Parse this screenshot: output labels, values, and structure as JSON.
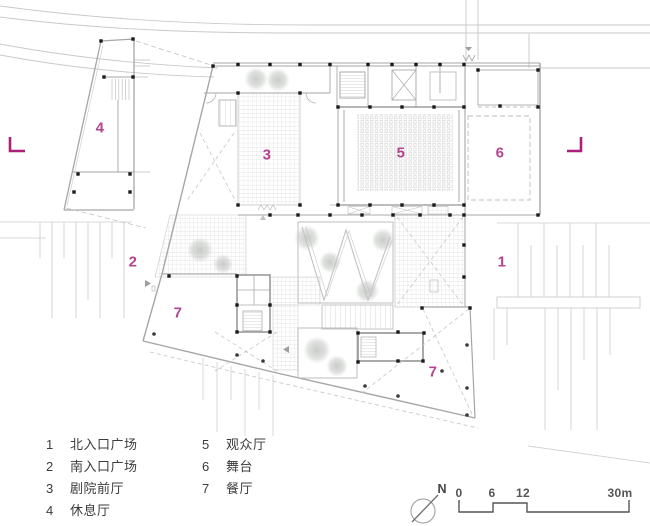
{
  "plan": {
    "zones": [
      {
        "id": "zone-4",
        "num": "4"
      },
      {
        "id": "zone-2",
        "num": "2"
      },
      {
        "id": "zone-3",
        "num": "3"
      },
      {
        "id": "zone-5",
        "num": "5"
      },
      {
        "id": "zone-6",
        "num": "6"
      },
      {
        "id": "zone-1",
        "num": "1"
      },
      {
        "id": "zone-7a",
        "num": "7"
      },
      {
        "id": "zone-7b",
        "num": "7"
      }
    ]
  },
  "legend": {
    "items": [
      {
        "num": "1",
        "label": "北入口广场"
      },
      {
        "num": "2",
        "label": "南入口广场"
      },
      {
        "num": "3",
        "label": "剧院前厅"
      },
      {
        "num": "4",
        "label": "休息厅"
      },
      {
        "num": "5",
        "label": "观众厅"
      },
      {
        "num": "6",
        "label": "舞台"
      },
      {
        "num": "7",
        "label": "餐厅"
      }
    ]
  },
  "compass": {
    "north_label": "N"
  },
  "scale_bar": {
    "tick0": "0",
    "tick1": "6",
    "tick2": "12",
    "end_label": "30m"
  },
  "colors": {
    "accent": "#b5438d",
    "section_mark": "#ab1f79",
    "wall_line": "#a6a6a6",
    "hatch_line": "#dcdcdc",
    "column": "#1b1b1b"
  }
}
